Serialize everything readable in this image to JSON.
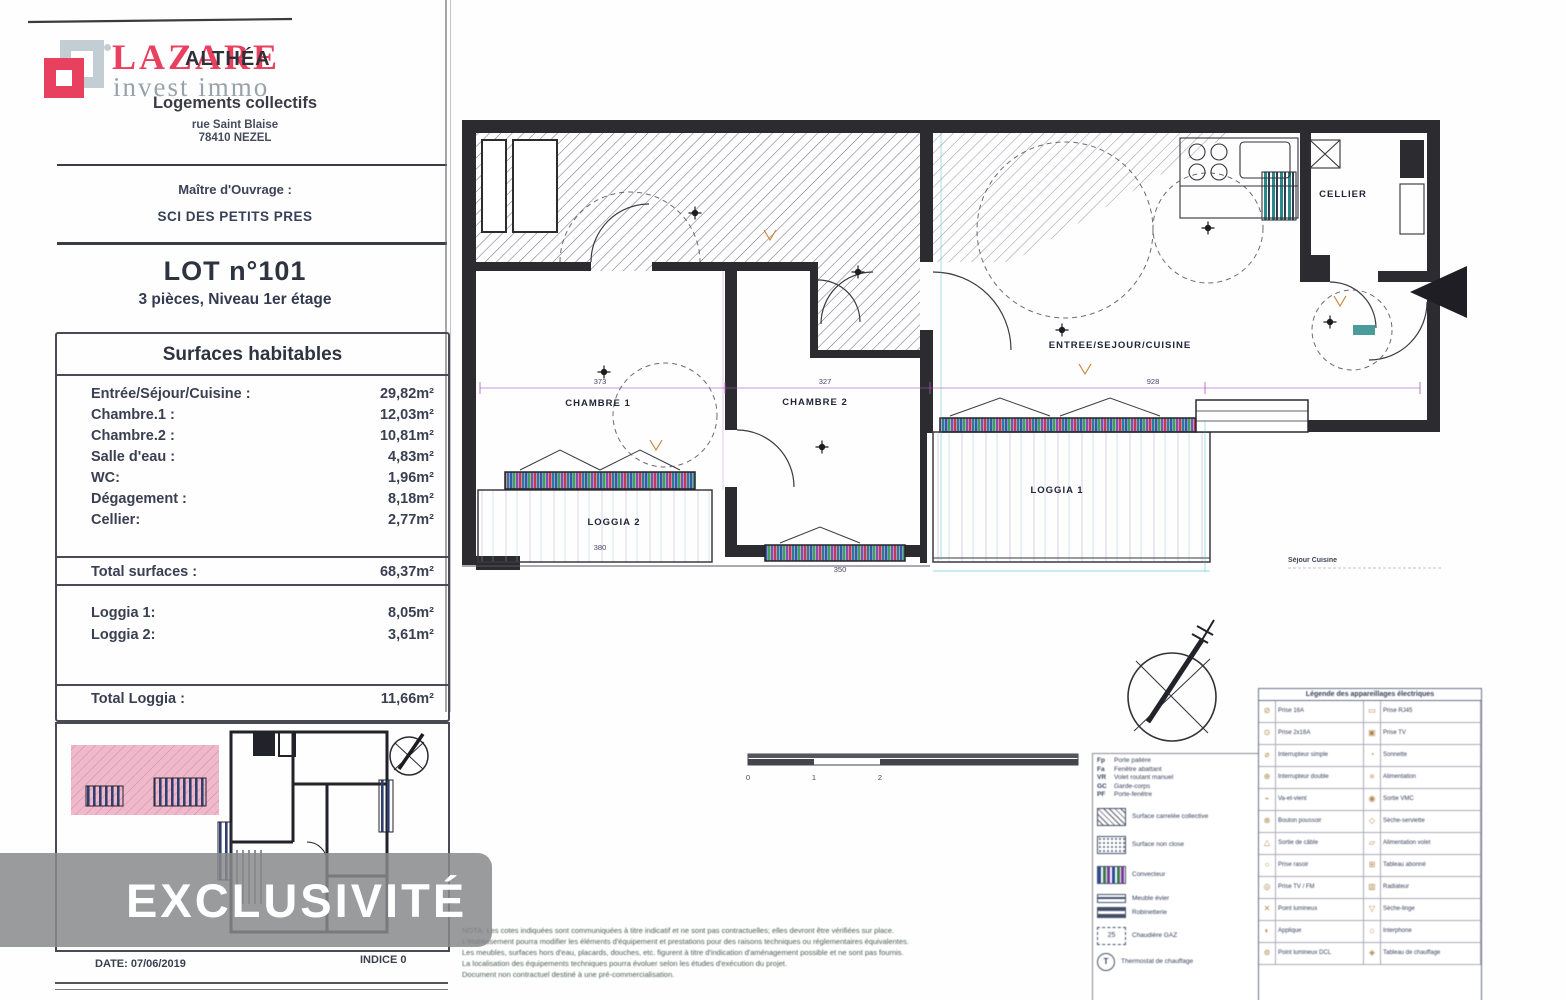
{
  "branding": {
    "logo_main": "LAZARE",
    "logo_sub": "invest immo"
  },
  "program": {
    "name": "ALTHÉA",
    "type": "Logements collectifs",
    "address1": "rue Saint Blaise",
    "address2": "78410 NEZEL"
  },
  "owner": {
    "label": "Maître d'Ouvrage :",
    "name": "SCI DES PETITS PRES"
  },
  "lot": {
    "title": "LOT n°101",
    "subtitle": "3 pièces, Niveau 1er étage"
  },
  "surfaces": {
    "title": "Surfaces habitables",
    "rows": [
      {
        "label": "Entrée/Séjour/Cuisine :",
        "value": "29,82m²"
      },
      {
        "label": "Chambre.1 :",
        "value": "12,03m²"
      },
      {
        "label": "Chambre.2 :",
        "value": "10,81m²"
      },
      {
        "label": "Salle d'eau :",
        "value": "4,83m²"
      },
      {
        "label": "WC:",
        "value": "1,96m²"
      },
      {
        "label": "Dégagement :",
        "value": "8,18m²"
      },
      {
        "label": "Cellier:",
        "value": "2,77m²"
      }
    ],
    "total": {
      "label": "Total surfaces :",
      "value": "68,37m²"
    },
    "loggias": [
      {
        "label": "Loggia 1:",
        "value": "8,05m²"
      },
      {
        "label": "Loggia 2:",
        "value": "3,61m²"
      }
    ],
    "total_loggia": {
      "label": "Total Loggia :",
      "value": "11,66m²"
    }
  },
  "watermark": "EXCLUSIVITÉ",
  "footer": {
    "date": "DATE: 07/06/2019",
    "indice": "INDICE 0"
  },
  "plan": {
    "rooms": {
      "chambre1": "CHAMBRE 1",
      "chambre2": "CHAMBRE 2",
      "sejour": "ENTREE/SEJOUR/CUISINE",
      "loggia1": "LOGGIA 1",
      "loggia2": "LOGGIA 2",
      "cellier": "CELLIER"
    },
    "note": "Séjour Cuisine",
    "dims": {
      "d1": "373",
      "d2": "327",
      "d3": "928",
      "d4": "380",
      "d5": "350"
    }
  },
  "scalebar": {
    "t0": "0",
    "t1": "1",
    "t2": "2"
  },
  "legend_left": {
    "abbrevs": [
      {
        "k": "Fp",
        "v": "Porte palière"
      },
      {
        "k": "Fa",
        "v": "Fenêtre abattant"
      },
      {
        "k": "VR",
        "v": "Volet roulant manuel"
      },
      {
        "k": "GC",
        "v": "Garde-corps"
      },
      {
        "k": "PF",
        "v": "Porte-fenêtre"
      }
    ],
    "items": [
      {
        "label": "Surface carrelée collective"
      },
      {
        "label": "Surface non close"
      },
      {
        "label": "Convecteur"
      },
      {
        "label": "Meuble évier"
      },
      {
        "label": "Robinetterie"
      },
      {
        "label": "Chaudière GAZ"
      },
      {
        "label": "Thermostat de chauffage"
      }
    ],
    "dash_sym": "25",
    "therm_sym": "T"
  },
  "legend_right": {
    "title": "Légende des appareillages électriques",
    "rows": [
      {
        "l": "Prise 16A",
        "r": "Prise RJ45"
      },
      {
        "l": "Prise 2x16A",
        "r": "Prise TV"
      },
      {
        "l": "Interrupteur simple",
        "r": "Sonnette"
      },
      {
        "l": "Interrupteur double",
        "r": "Alimentation"
      },
      {
        "l": "Va-et-vient",
        "r": "Sortie VMC"
      },
      {
        "l": "Bouton poussoir",
        "r": "Sèche-serviette"
      },
      {
        "l": "Sortie de câble",
        "r": "Alimentation volet"
      },
      {
        "l": "Prise rasoir",
        "r": "Tableau abonné"
      },
      {
        "l": "Prise TV / FM",
        "r": "Radiateur"
      },
      {
        "l": "Point lumineux",
        "r": "Sèche-linge"
      },
      {
        "l": "Applique",
        "r": "Interphone"
      },
      {
        "l": "Point lumineux DCL",
        "r": "Tableau de chauffage"
      }
    ]
  },
  "disclaimer": {
    "l1": "NOTA: Les cotes indiquées sont communiquées à titre indicatif et ne sont pas contractuelles; elles devront être vérifiées sur place.",
    "l2": "L'établissement pourra modifier les éléments d'équipement et prestations pour des raisons techniques ou réglementaires équivalentes.",
    "l3": "Les meubles, surfaces hors d'eau, placards, douches, etc. figurent à titre d'indication d'aménagement possible et ne sont pas fournis.",
    "l4": "La localisation des équipements techniques pourra évoluer selon les études d'exécution du projet.",
    "l5": "Document non contractuel destiné à une pré-commercialisation."
  }
}
